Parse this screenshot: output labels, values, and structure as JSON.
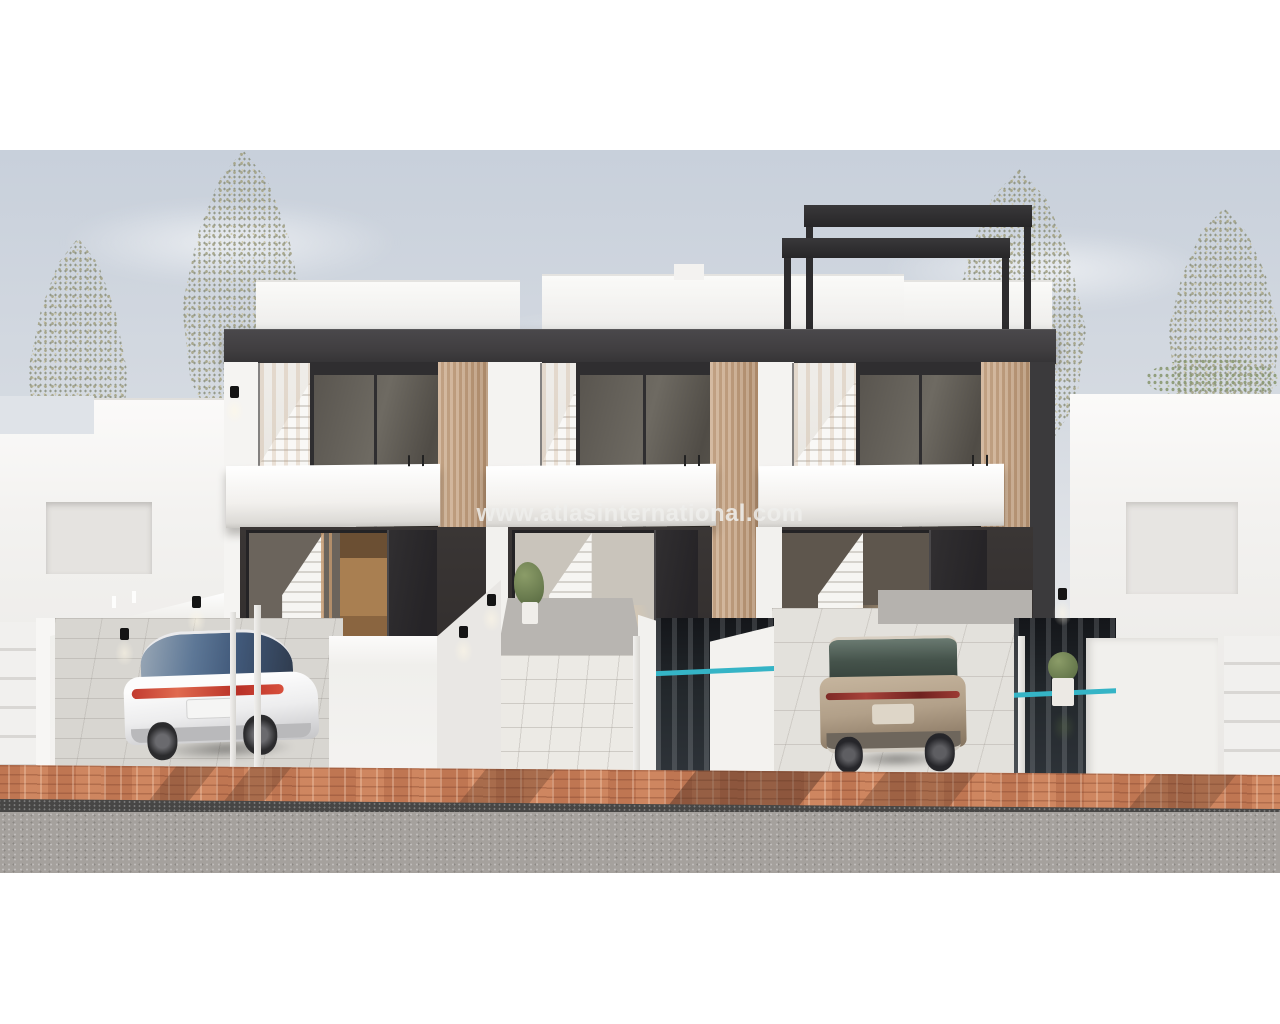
{
  "watermark": {
    "text": "www.atlasinternational.com"
  },
  "palette": {
    "letterbox": "#ffffff",
    "sky_top": "#c8d0db",
    "sky_bottom": "#e9eaec",
    "fascia_dark": "#403e40",
    "wood": "#c7a687",
    "white_wall": "#f3f2f0",
    "brick": "#c6805a",
    "curb": "#474645",
    "road": "#a5a19d",
    "pool_water": "#23282c",
    "pool_waterline": "#35b4c6",
    "car_white": "#fcfcfc",
    "car_tan": "#b2a089",
    "watermark_color": "rgba(238,238,236,0.85)"
  }
}
